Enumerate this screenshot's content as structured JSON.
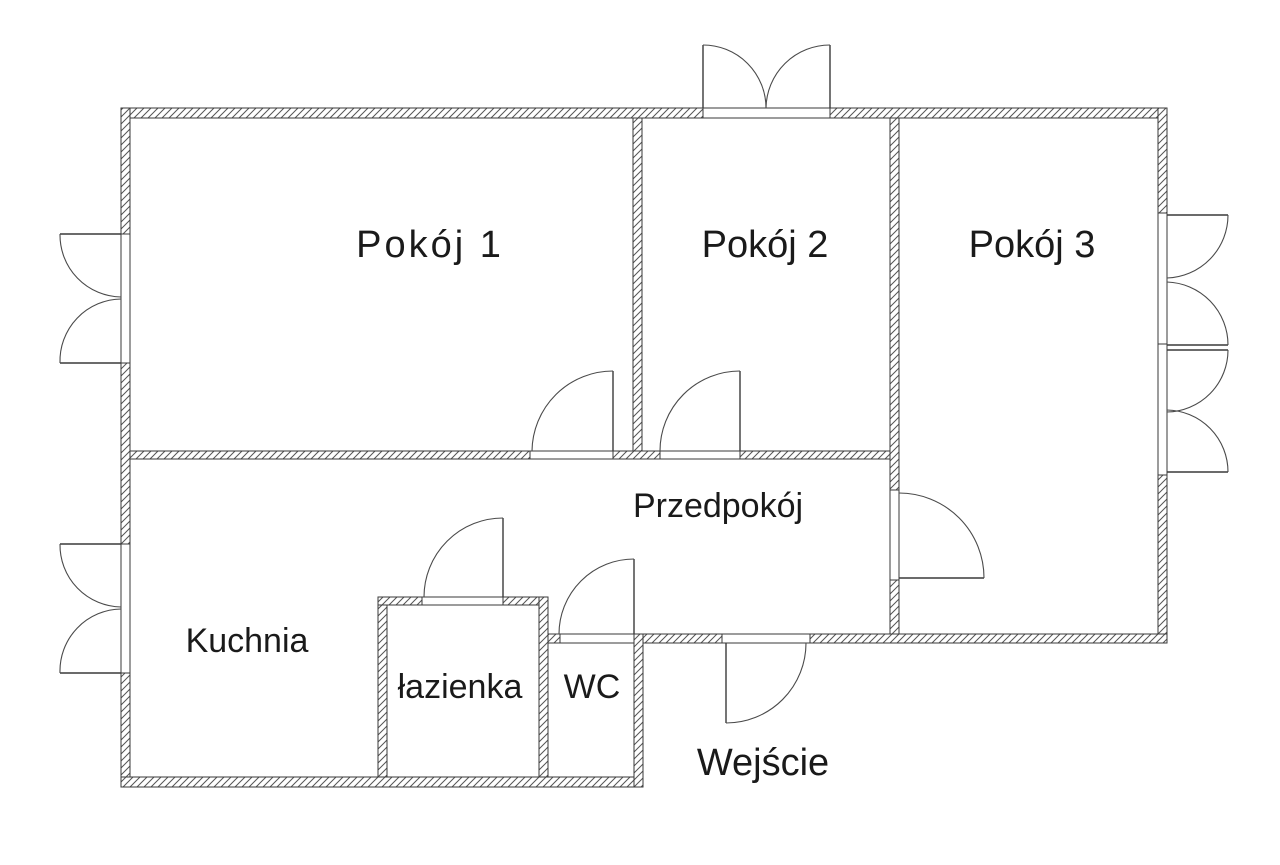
{
  "diagram": {
    "type": "apartment-floor-plan",
    "background_color": "#ffffff",
    "wall_line_color": "#3a3a3a",
    "text_color": "#1a1a1a",
    "labels": {
      "room1": "Pokój 1",
      "room2": "Pokój 2",
      "room3": "Pokój 3",
      "hallway": "Przedpokój",
      "kitchen": "Kuchnia",
      "bathroom": "łazienka",
      "wc": "WC",
      "entrance": "Wejście"
    },
    "features": {
      "rooms": [
        "Pokój 1",
        "Pokój 2",
        "Pokój 3",
        "Przedpokój",
        "Kuchnia",
        "łazienka",
        "WC"
      ],
      "entrance_label": "Wejście",
      "window_count": 4,
      "door_count": 7
    }
  }
}
